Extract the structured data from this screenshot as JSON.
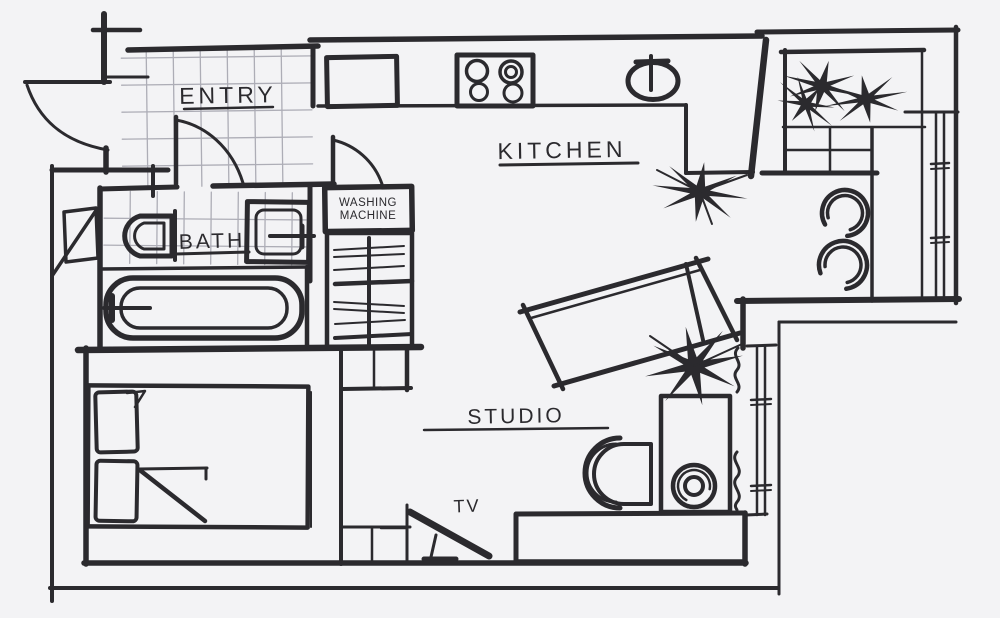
{
  "title": "Studio Apartment Floor Plan Sketch",
  "colors": {
    "background": "#f3f3f5",
    "ink": "#2b2a2e",
    "tile_line": "#adadb6"
  },
  "rooms": {
    "entry": {
      "label": "ENTRY"
    },
    "kitchen": {
      "label": "KITCHEN"
    },
    "bath": {
      "label": "BATH"
    },
    "studio": {
      "label": "STUDIO"
    }
  },
  "appliances": {
    "washing_machine": {
      "line1": "WASHING",
      "line2": "MACHINE"
    },
    "tv": {
      "label": "TV"
    }
  },
  "fixtures": {
    "entry": [
      "entrance-door",
      "interior-door",
      "tiled-floor"
    ],
    "bath": [
      "toilet",
      "washbasin",
      "bathtub",
      "tiled-floor",
      "wall-mirror"
    ],
    "laundry": [
      "washing-machine",
      "wardrobe-with-hangers"
    ],
    "kitchen": [
      "upper-cabinet",
      "four-burner-stove",
      "round-sink",
      "corner-plant",
      "l-shaped-counter"
    ],
    "dining_nook": [
      "planter-box",
      "palm-plant",
      "shelf-grid",
      "dining-table",
      "round-stool",
      "round-stool",
      "window"
    ],
    "studio": [
      "tilted-daybed",
      "floor-plant",
      "desk-with-speaker",
      "desk-chair",
      "radiator-squiggle",
      "bench-sofa",
      "tv-on-stand",
      "window",
      "low-cabinet"
    ],
    "bedroom": [
      "double-bed",
      "pillow",
      "pillow",
      "folded-blanket"
    ]
  }
}
